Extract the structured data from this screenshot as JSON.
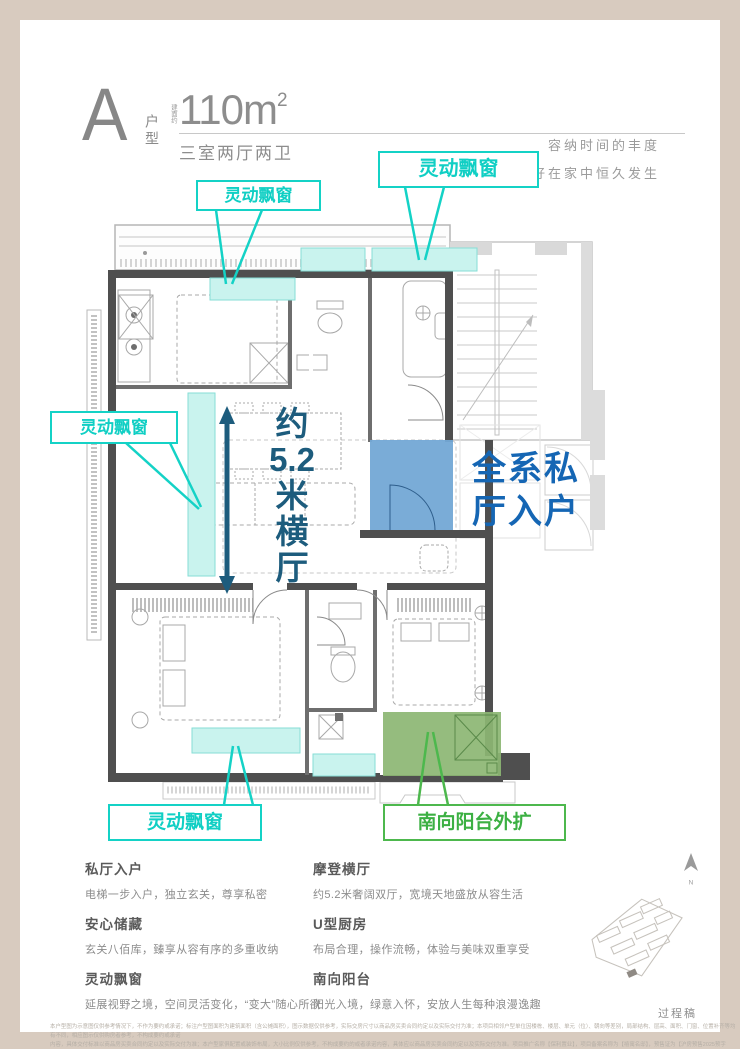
{
  "header": {
    "unit_letter": "A",
    "unit_type_label": "户型",
    "area_prefix": "建面约",
    "area_value": "110m",
    "area_superscript": "2",
    "rooms_text": "三室两厅两卫",
    "tagline_line1": "容纳时间的丰度",
    "tagline_line2": "让美好在家中恒久发生"
  },
  "plan": {
    "callouts": [
      {
        "label": "灵动飘窗"
      },
      {
        "label": "灵动飘窗"
      },
      {
        "label": "灵动飘窗"
      },
      {
        "label": "灵动飘窗"
      },
      {
        "label": "南向阳台外扩"
      }
    ],
    "hall_label": [
      "约",
      "5.2",
      "米",
      "横",
      "厅"
    ],
    "entry_label_line1": "全系私",
    "entry_label_line2": "厅入户",
    "colors": {
      "callout_teal": "#14d2c6",
      "window_fill": "#c9f3ee",
      "foyer_blue_fill": "#73a8d5",
      "entry_text_blue": "#1566b4",
      "hall_arrow_teal": "#1d5c7d",
      "balcony_green_fill": "#8cb673",
      "balcony_green_text": "#3cb043",
      "wall_gray": "#4f4f4f"
    }
  },
  "features": {
    "left": [
      {
        "title": "私厅入户",
        "desc": "电梯一步入户，独立玄关，尊享私密"
      },
      {
        "title": "安心储藏",
        "desc": "玄关八佰库，臻享从容有序的多重收纳"
      },
      {
        "title": "灵动飘窗",
        "desc": "延展视野之境，空间灵活变化，“变大”随心所欲"
      }
    ],
    "right": [
      {
        "title": "摩登横厅",
        "desc": "约5.2米奢阔双厅，宽境天地盛放从容生活"
      },
      {
        "title": "U型厨房",
        "desc": "布局合理，操作流畅，体验与美味双重享受"
      },
      {
        "title": "南向阳台",
        "desc": "阳光入境，绿意入怀，安放人生每种浪漫逸趣"
      }
    ]
  },
  "footer": {
    "compass_label": "N",
    "draft_label": "过程稿",
    "disclaimer_line1": "本户型图为示意图仅供参考情况下，不作为要约或承诺；标注户型图面积为建筑面积（含公摊面积），图示数据仅供参考，实际交房尺寸以商品房买卖合同约定以及实际交付为准；本项目相邻户型单位因楼栋、楼层、单元（位）、朝向等差别，局部结构、层高、面积、门窗、位置补齐等均有不同，相应图示仅供购房者参考，不构成要约或承诺",
    "disclaimer_line2": "内容，具体交付标准以商品房买卖合同约定以及实际交付为准；本户型家俱配置或装饰布局，大小比例仅供参考，不构成要约的或者承诺内容，具体应以商品房买卖合同约定以及实际交付为准。项目推广名称【保利置业】，项目备案名称为【禧寓名邸】，预售证为【沪房预售2025预字0000357号】，开发商为【上海保利置业有限",
    "disclaimer_line3": "公司】，图纸制作时间为2025年1月。"
  }
}
